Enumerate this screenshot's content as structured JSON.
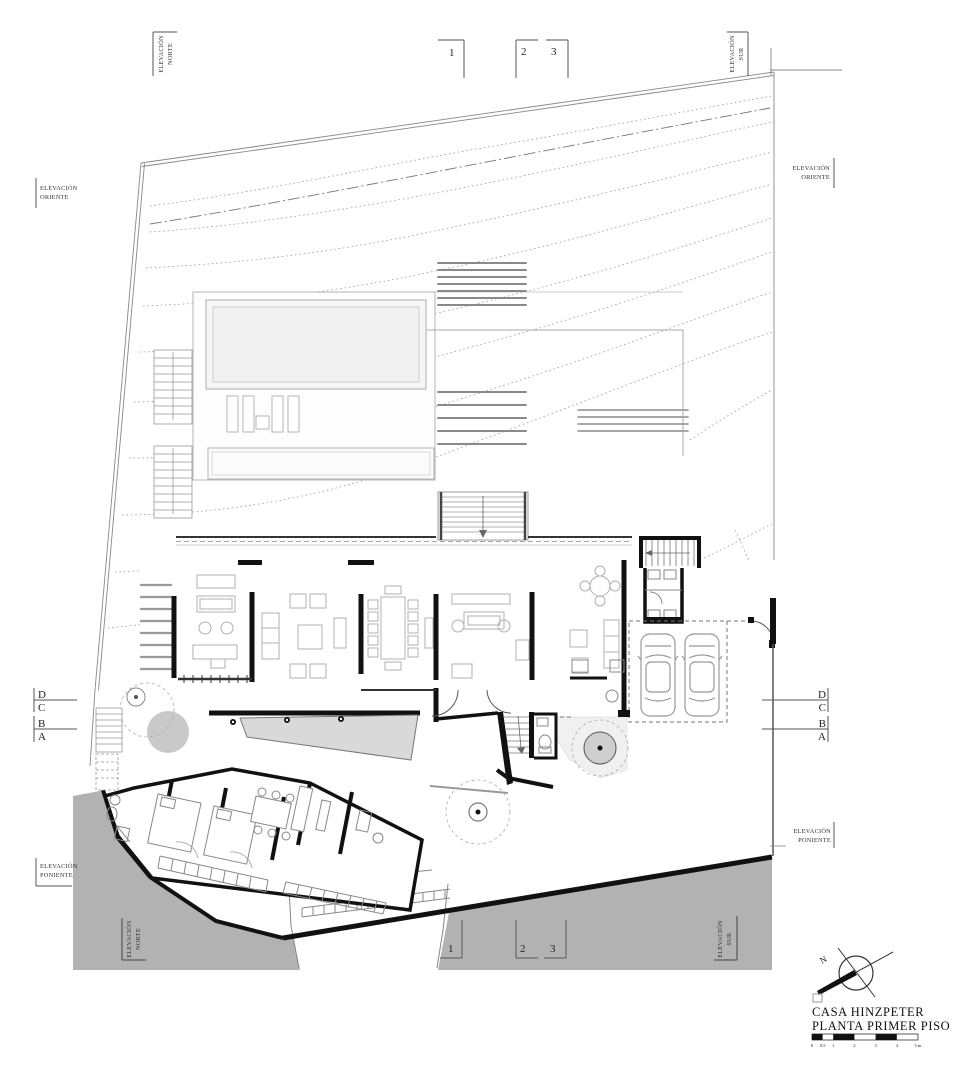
{
  "drawing": {
    "title_line1": "CASA HINZPETER",
    "title_line2": "PLANTA PRIMER PISO",
    "north_label": "N"
  },
  "grid": {
    "columns": [
      "1",
      "2",
      "3"
    ],
    "rows": [
      "D",
      "C",
      "B",
      "A"
    ]
  },
  "elevations": {
    "norte": {
      "line1": "ELEVACIÓN",
      "line2": "NORTE"
    },
    "sur": {
      "line1": "ELEVACIÓN",
      "line2": "SUR"
    },
    "oriente": {
      "line1": "ELEVACIÓN",
      "line2": "ORIENTE"
    },
    "poniente": {
      "line1": "ELEVACIÓN",
      "line2": "PONIENTE"
    }
  },
  "scale_bar": {
    "ticks": [
      "0",
      "0.5",
      "1",
      "2",
      "3",
      "4",
      "5 m"
    ]
  },
  "colors": {
    "slope_gray": "#b2b2b2",
    "ramp_gray": "#d9d9d9",
    "tree_gray": "#c9c9c9",
    "wall_black": "#111111",
    "thin_line": "#999999"
  }
}
